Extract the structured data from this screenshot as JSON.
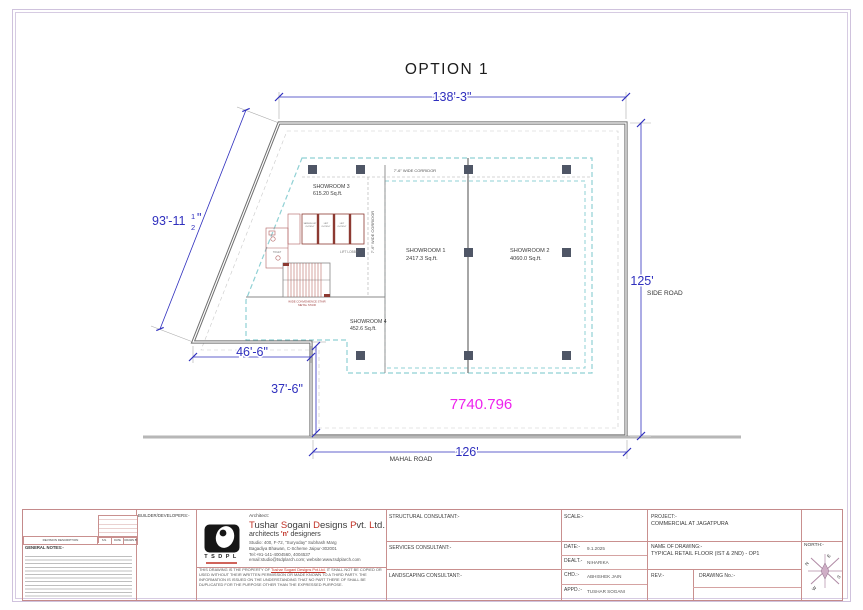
{
  "sheet": {
    "title": "OPTION 1"
  },
  "plan": {
    "dim_top": "138'-3\"",
    "dim_left_main": "93'-11",
    "dim_left_num": "1",
    "dim_left_den": "2",
    "dim_left_suffix": "\"",
    "dim_right": "125'",
    "dim_bottom": "126'",
    "dim_notch_w": "46'-6\"",
    "dim_notch_h": "37'-6\"",
    "road_right": "SIDE ROAD",
    "road_bottom": "MAHAL ROAD",
    "area_total": "7740.796",
    "corridor_top": "7'-6\" WIDE CORRIDOR",
    "corridor_left": "7'-6\" WIDE CORRIDOR",
    "rooms": [
      {
        "name": "SHOWROOM 1",
        "area": "2417.3 Sq.ft."
      },
      {
        "name": "SHOWROOM 2",
        "area": "4060.0 Sq.ft."
      },
      {
        "name": "SHOWROOM 3",
        "area": "615.20 Sq.ft."
      },
      {
        "name": "SHOWROOM 4",
        "area": "452.6 Sq.ft."
      }
    ],
    "core": {
      "lift_service": "SERVICE LIFT",
      "lift": "LIFT",
      "lift_size": "6'-0\"X6'-0\"",
      "lobby": "LIFT LOBBY",
      "toilet": "TOILET",
      "stair_note1": "WIDE CONVENIENCE STAIR",
      "stair_note2": "METAL STAIR"
    }
  },
  "title_block": {
    "revision": {
      "description_label": "REVISION DESCRIPTION",
      "col_sn": "S.N.",
      "col_date": "DATE",
      "col_drawn": "DRAWN BY"
    },
    "general_notes_label": "GENERAL NOTES:-",
    "builder_label": "BUILDER/DEVELOPERS:-",
    "architect": {
      "label": "Architect:",
      "firm_parts": [
        {
          "t": "T"
        },
        {
          "t": "ushar "
        },
        {
          "t": "S"
        },
        {
          "t": "ogani "
        },
        {
          "t": "D"
        },
        {
          "t": "esigns "
        },
        {
          "t": "P"
        },
        {
          "t": "vt. "
        },
        {
          "t": "L"
        },
        {
          "t": "td."
        }
      ],
      "tagline_1": "architects ",
      "tagline_n": "'n'",
      "tagline_2": " designers",
      "addr1": "Studio: 400, F-72, \"Suryoday\" Subhash Marg",
      "addr2": "Bagadiya Bhawan, C-Scheme Jaipur-302001",
      "addr3": "Tel:+91-141-4004560, 4004537",
      "addr4": "email:studio@tsdplarch.com; website:www.tsdplarch.com",
      "logo_text": "TSDPL"
    },
    "disclaimer_pre": "THIS DRAWING IS THE PROPERTY OF ",
    "disclaimer_firm": "Tushar Sogani Designs Pvt.Ltd.",
    "disclaimer_post": " IT SHALL NOT BE COPIED OR USED WITHOUT THEIR WRITTEN PERMISSION OR MADE KNOWN TO A THIRD PARTY. THE INFORMATION IS ISSUED ON THE UNDERSTANDING THAT NO PART THERE OF SHALL BE DUPLICATED FOR THE PURPOSE OTHER THAN THE EXPRESSED PURPOSE.",
    "structural_label": "STRUCTURAL CONSULTANT:-",
    "services_label": "SERVICES CONSULTANT:-",
    "landscaping_label": "LANDSCAPING CONSULTANT:-",
    "scale_label": "SCALE:-",
    "date_label": "DATE:-",
    "date_value": "9.1.2025",
    "dealt_label": "DEALT.-",
    "dealt_value": "NIHARIKA",
    "chd_label": "CHD.:-",
    "chd_value": "ABHISHEK JAIN",
    "appd_label": "APPD.:-",
    "appd_value": "TUSHAR SOGANI",
    "project_label": "PROJECT:-",
    "project_value": "COMMERCIAL AT JAGATPURA",
    "drawing_label": "NAME OF DRAWING:-",
    "drawing_value": "TYPICAL RETAIL FLOOR (IST & 2ND) - OP1",
    "rev_label": "REV:-",
    "drawing_no_label": "DRAWING No.:-",
    "north_label": "NORTH:-",
    "compass": {
      "n": "N",
      "e": "E",
      "s": "S",
      "w": "W"
    }
  }
}
